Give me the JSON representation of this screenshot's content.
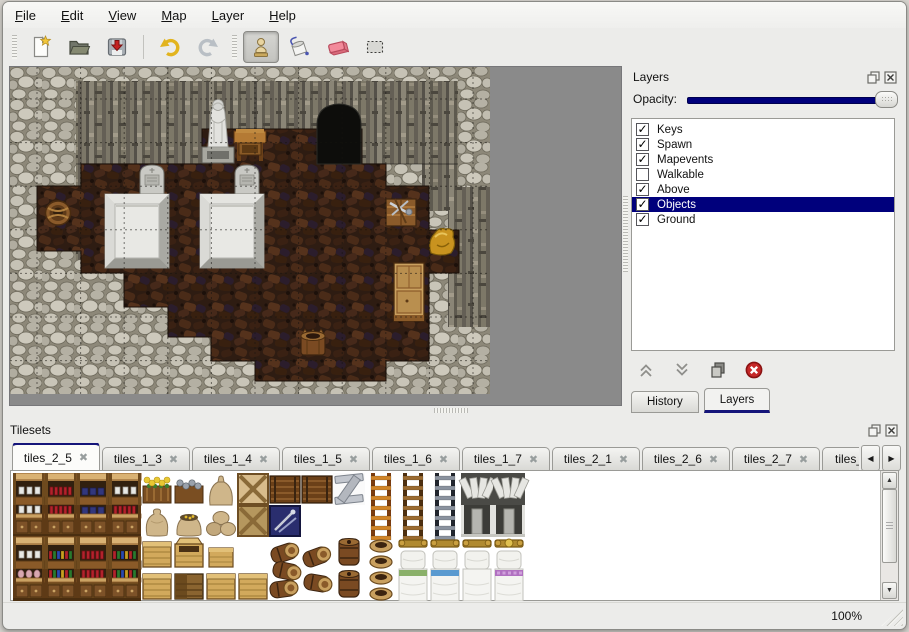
{
  "window": {
    "background": "#ececea",
    "accent": "#00007c"
  },
  "menu": {
    "items": [
      {
        "label": "File"
      },
      {
        "label": "Edit"
      },
      {
        "label": "View"
      },
      {
        "label": "Map"
      },
      {
        "label": "Layer"
      },
      {
        "label": "Help"
      }
    ]
  },
  "toolbar": {
    "buttons": [
      {
        "name": "new",
        "group": 0
      },
      {
        "name": "open",
        "group": 0
      },
      {
        "name": "save",
        "group": 0
      },
      {
        "name": "undo",
        "group": 1
      },
      {
        "name": "redo",
        "group": 1
      },
      {
        "name": "stamp",
        "group": 2,
        "selected": true
      },
      {
        "name": "fill",
        "group": 2
      },
      {
        "name": "eraser",
        "group": 2
      },
      {
        "name": "select",
        "group": 2
      }
    ]
  },
  "layers_panel": {
    "title": "Layers",
    "opacity_label": "Opacity:",
    "opacity_value": 100,
    "layers": [
      {
        "label": "Keys",
        "checked": true,
        "selected": false
      },
      {
        "label": "Spawn",
        "checked": true,
        "selected": false
      },
      {
        "label": "Mapevents",
        "checked": true,
        "selected": false
      },
      {
        "label": "Walkable",
        "checked": false,
        "selected": false
      },
      {
        "label": "Above",
        "checked": true,
        "selected": false
      },
      {
        "label": "Objects",
        "checked": true,
        "selected": true
      },
      {
        "label": "Ground",
        "checked": true,
        "selected": false
      }
    ],
    "actions": [
      "move-up",
      "move-down",
      "duplicate",
      "delete"
    ],
    "tabs": [
      {
        "label": "History",
        "active": false
      },
      {
        "label": "Layers",
        "active": true
      }
    ]
  },
  "tilesets_panel": {
    "title": "Tilesets",
    "tabs": [
      {
        "label": "tiles_2_5",
        "active": true
      },
      {
        "label": "tiles_1_3",
        "active": false
      },
      {
        "label": "tiles_1_4",
        "active": false
      },
      {
        "label": "tiles_1_5",
        "active": false
      },
      {
        "label": "tiles_1_6",
        "active": false
      },
      {
        "label": "tiles_1_7",
        "active": false
      },
      {
        "label": "tiles_2_1",
        "active": false
      },
      {
        "label": "tiles_2_6",
        "active": false
      },
      {
        "label": "tiles_2_7",
        "active": false
      },
      {
        "label": "tiles_",
        "active": false,
        "truncated": true
      }
    ],
    "palette": {
      "tile_size": 32,
      "tiles": [
        {
          "t": "shelf_top",
          "v": "white",
          "c": 0,
          "r": 0
        },
        {
          "t": "shelf_top",
          "v": "red",
          "c": 1,
          "r": 0
        },
        {
          "t": "shelf_top",
          "v": "blue",
          "c": 2,
          "r": 0
        },
        {
          "t": "shelf_top",
          "v": "white",
          "c": 3,
          "r": 0
        },
        {
          "t": "planter",
          "c": 4,
          "r": 0
        },
        {
          "t": "graybox",
          "c": 5,
          "r": 0
        },
        {
          "t": "sack_top",
          "c": 6,
          "r": 0
        },
        {
          "t": "cratex",
          "v": "light",
          "c": 7,
          "r": 0
        },
        {
          "t": "chest",
          "c": 8,
          "r": 0
        },
        {
          "t": "chest",
          "c": 9,
          "r": 0
        },
        {
          "t": "plankz",
          "c": 10,
          "r": 0
        },
        {
          "t": "ladder",
          "v": "orange",
          "c": 11,
          "r": 0,
          "h": 2
        },
        {
          "t": "ladder",
          "v": "brown",
          "c": 12,
          "r": 0,
          "h": 2
        },
        {
          "t": "ladder",
          "v": "dark",
          "c": 13,
          "r": 0,
          "h": 2
        },
        {
          "t": "arch_top",
          "c": 14,
          "r": 0
        },
        {
          "t": "arch_top",
          "c": 15,
          "r": 0
        },
        {
          "t": "shelf_bot",
          "v": "white",
          "c": 0,
          "r": 1
        },
        {
          "t": "shelf_bot",
          "v": "red",
          "c": 1,
          "r": 1
        },
        {
          "t": "shelf_bot",
          "v": "blue",
          "c": 2,
          "r": 1
        },
        {
          "t": "shelf_bot",
          "v": "red",
          "c": 3,
          "r": 1
        },
        {
          "t": "sack",
          "c": 4,
          "r": 1
        },
        {
          "t": "sack_open",
          "c": 5,
          "r": 1
        },
        {
          "t": "sack_pile",
          "c": 6,
          "r": 1
        },
        {
          "t": "cratex",
          "v": "dark",
          "c": 7,
          "r": 1
        },
        {
          "t": "navycrate",
          "c": 8,
          "r": 1
        },
        {
          "t": "arch_dark",
          "c": 14,
          "r": 1
        },
        {
          "t": "arch_dark",
          "c": 15,
          "r": 1
        },
        {
          "t": "shelf_top",
          "v": "white",
          "c": 0,
          "r": 2
        },
        {
          "t": "shelf_top",
          "v": "mixed",
          "c": 1,
          "r": 2
        },
        {
          "t": "shelf_top",
          "v": "red",
          "c": 2,
          "r": 2
        },
        {
          "t": "shelf_top",
          "v": "mixed",
          "c": 3,
          "r": 2
        },
        {
          "t": "crate",
          "c": 4,
          "r": 2
        },
        {
          "t": "crate_open",
          "c": 5,
          "r": 2
        },
        {
          "t": "crate_small",
          "c": 6,
          "r": 2
        },
        {
          "t": "barrel_pile",
          "c": 8,
          "r": 2,
          "h": 2
        },
        {
          "t": "barrels_lying",
          "c": 9,
          "r": 2,
          "h": 2
        },
        {
          "t": "barrels_stack",
          "c": 10,
          "r": 2,
          "h": 2
        },
        {
          "t": "pots",
          "c": 11,
          "r": 2,
          "h": 2
        },
        {
          "t": "bed_head",
          "c": 12,
          "r": 2
        },
        {
          "t": "bed_head",
          "c": 13,
          "r": 2
        },
        {
          "t": "bed_head",
          "c": 14,
          "r": 2
        },
        {
          "t": "bed_head",
          "v": "fancy",
          "c": 15,
          "r": 2
        },
        {
          "t": "shelf_bot",
          "v": "jars",
          "c": 0,
          "r": 3
        },
        {
          "t": "shelf_bot",
          "v": "mixed",
          "c": 1,
          "r": 3
        },
        {
          "t": "shelf_bot",
          "v": "red",
          "c": 2,
          "r": 3
        },
        {
          "t": "shelf_bot",
          "v": "mixed",
          "c": 3,
          "r": 3
        },
        {
          "t": "crate",
          "c": 4,
          "r": 3
        },
        {
          "t": "crate_dark",
          "c": 5,
          "r": 3
        },
        {
          "t": "crate",
          "c": 6,
          "r": 3
        },
        {
          "t": "crate",
          "c": 7,
          "r": 3
        },
        {
          "t": "bed_foot",
          "v": "green",
          "c": 12,
          "r": 3
        },
        {
          "t": "bed_foot",
          "v": "blue",
          "c": 13,
          "r": 3
        },
        {
          "t": "bed_foot",
          "v": "white",
          "c": 14,
          "r": 3
        },
        {
          "t": "bed_foot",
          "v": "purple",
          "c": 15,
          "r": 3
        }
      ]
    }
  },
  "map_view": {
    "background": "#8a8a8a",
    "canvas_width": 480,
    "canvas_height": 327,
    "wall_band": {
      "x": 66,
      "y": 14,
      "w": 382,
      "h": 83
    },
    "wall_patches": [
      {
        "x": 66,
        "y": 97,
        "w": 64,
        "h": 96
      },
      {
        "x": 412,
        "y": 14,
        "w": 36,
        "h": 130
      },
      {
        "x": 438,
        "y": 120,
        "w": 42,
        "h": 140
      }
    ],
    "cave_path": "M307,97 L307,58 Q307,38 329,37 Q351,38 351,58 L351,97 Z",
    "floor_path": "M27,163 L27,119 L71,119 L71,97 L192,97 L192,62 L352,62 L352,97 L376,97 L376,119 L419,119 L419,163 L449,163 L449,206 L419,206 L419,294 L376,294 L376,314 L245,314 L245,294 L201,294 L201,270 L158,270 L158,240 L114,240 L114,206 L71,206 L71,184 L27,184 Z",
    "grid": {
      "step": 43.6,
      "offset_x": 27,
      "offset_y": 32
    },
    "objects": [
      {
        "t": "statue",
        "x": 192,
        "y": 30
      },
      {
        "t": "table",
        "x": 224,
        "y": 62
      },
      {
        "t": "tombstone",
        "x": 129,
        "y": 97
      },
      {
        "t": "tombstone",
        "x": 224,
        "y": 97
      },
      {
        "t": "platform",
        "x": 95,
        "y": 127
      },
      {
        "t": "platform",
        "x": 190,
        "y": 127
      },
      {
        "t": "basket",
        "x": 35,
        "y": 133
      },
      {
        "t": "toolcrate",
        "x": 376,
        "y": 130
      },
      {
        "t": "goldsack",
        "x": 417,
        "y": 158
      },
      {
        "t": "cabinet",
        "x": 384,
        "y": 196
      },
      {
        "t": "barrel",
        "x": 289,
        "y": 260
      }
    ]
  },
  "status_bar": {
    "zoom": "100%"
  }
}
